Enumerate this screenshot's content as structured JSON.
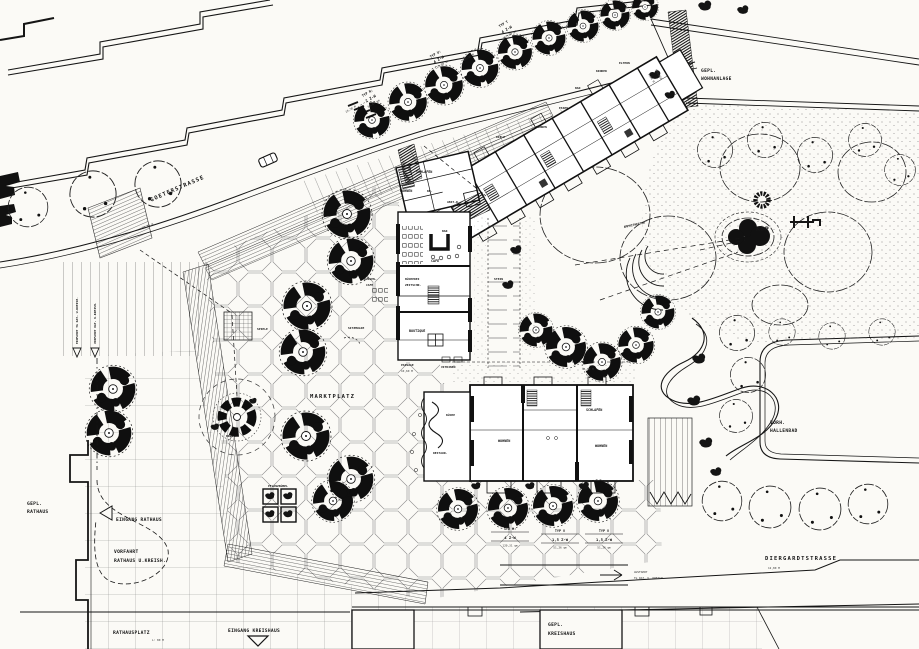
{
  "streets": {
    "goeterstrasse": "GOETERSTRASSE",
    "goeter_dim": "10,60 M",
    "diergardtstrasse": "DIERGARDTSTRASSE",
    "diergardt_dim": "12,80 M"
  },
  "places": {
    "marktplatz": "MARKTPLATZ",
    "rathausplatz": "RATHAUSPLATZ",
    "rathausplatz_dim": "L: 80 M",
    "gepl_wohnanlage": [
      "GEPL.",
      "WOHNANLAGE"
    ],
    "gepl_rathaus": [
      "GEPL.",
      "RATHAUS"
    ],
    "gepl_kreishaus": [
      "GEPL.",
      "KREISHAUS"
    ],
    "vorh_hallenbad": [
      "VORH.",
      "HALLENBAD"
    ],
    "amphitheater": "AMPHITHEATER",
    "ksp": "KSP",
    "wasser": "WASSER",
    "stein": "STEIN",
    "spiele": "SPIELE",
    "brunnen": "BRUNNEN",
    "pflanzkuebel": "PFLANZKÜBEL",
    "sitzmulde": "SITZMULDE",
    "sitzen": "SITZEN",
    "sitzen_dim": "45,60 M",
    "passage_block": [
      "PASSAGE",
      "1,50 M"
    ]
  },
  "access": {
    "eingang_rathaus": "EINGANG RATHAUS",
    "eingang_kreishaus": "EINGANG KREISHAUS",
    "vorfahrt_rathaus": [
      "VORFAHRT",
      "RATHAUS U.KREISH."
    ],
    "einfahrt_tg": "EINFAHRT TG RAT- U.KREISH.",
    "vorfahrt_tg": "VORFAHRT RAT- U.KREISH.",
    "ausfahrt_tg": [
      "AUSFAHRT",
      "TG RAT- U. KREISH."
    ]
  },
  "shops": {
    "cafe": "CAFE",
    "bar": "BAR",
    "aussen_cafe": [
      "AUSSEN-",
      "CAFE"
    ],
    "buecherei": [
      "BÜCHEREI",
      "ZEITSCHR."
    ],
    "boutique": "BOUTIQUE",
    "passage": [
      "PASSAGE",
      "10,60 M"
    ],
    "vitrinen": "VITRINEN",
    "restaurant": "RESTAUR.",
    "kueche": "KÜCHE"
  },
  "rooms": {
    "wohnen": "WOHNEN",
    "schlafen": "SCHLAFEN",
    "eltern": "ELTERN",
    "kinder": "KINDER",
    "diele": "DIELE",
    "essen": "ESSEN",
    "bad": "BAD",
    "abst": "ABST-R.",
    "kb": "KB."
  },
  "unit_types": {
    "typ_r": [
      "TYP R:",
      "2 Z-W",
      "65,67 qm"
    ],
    "typ_u_row": [
      "TYP U:",
      "4 Z-W",
      "115,89 qm"
    ],
    "typ_t": [
      "TYP T",
      "4 Z-W",
      "117,89 qm"
    ],
    "typ_u": [
      "TYP U:",
      "4 Z-W",
      "120,31 qm"
    ],
    "typ_v_1": [
      "TYP V",
      "1,5 Z-W",
      "51,26 qm"
    ],
    "typ_v_2": [
      "TYP V",
      "1,5 Z-W",
      "51,26 qm"
    ]
  },
  "dims": {
    "d19_1": "19,50 M",
    "d19_2": "19,50 M"
  },
  "colors": {
    "paper": "#fbfaf6",
    "ink": "#151515"
  }
}
